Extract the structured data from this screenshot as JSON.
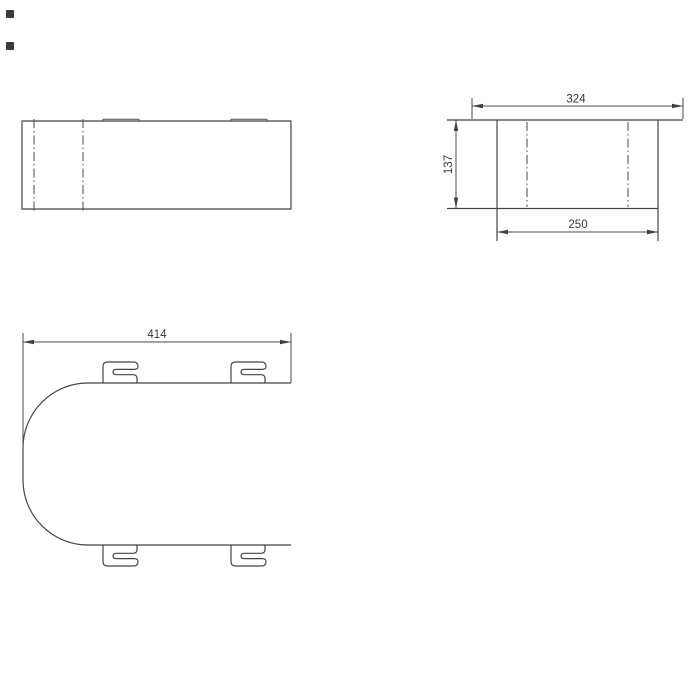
{
  "drawing": {
    "background": "#ffffff",
    "line_color": "#454545",
    "dimensions": {
      "side_overall_width": {
        "value": "324"
      },
      "side_height": {
        "value": "137"
      },
      "side_body_width": {
        "value": "250"
      },
      "plan_length": {
        "value": "414"
      }
    }
  }
}
